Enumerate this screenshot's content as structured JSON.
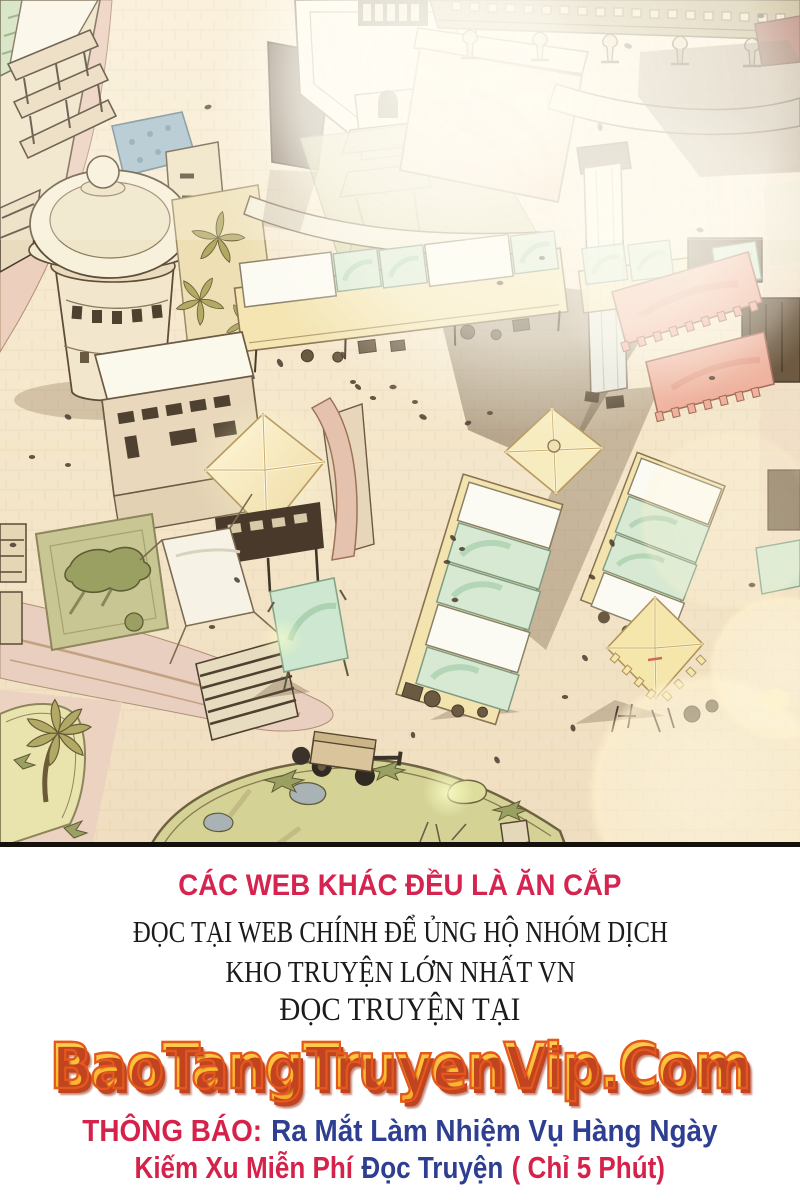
{
  "panel": {
    "caption": "Aerial view of a sunlit market plaza: domed tower, scaffolded buildings, rows of stalls with white and mint canopies, pink fringed awnings, glowing pavilion roofs, garden square, palm trees, a cart and a park, washed by bright lens flares",
    "palette": {
      "ground": "#f5e7cb",
      "road_pink": "#ecd2c0",
      "canopy_white": "#fcfbf3",
      "canopy_mint": "#d7e9d3",
      "awning_pink": "#efb29e",
      "roof_glow": "#f7ecc0",
      "garden_green": "#c8c794",
      "park_green": "#d4d295",
      "tower_cream": "#f2e7cc",
      "blue_roof": "#a9c2cd",
      "outline_brown": "#5e4d3a",
      "shadow_brown": "rgba(98,77,54,0.42)"
    }
  },
  "notice": {
    "warning": "CÁC WEB KHÁC ĐỀU LÀ ĂN CẮP",
    "support_line": "ĐỌC TẠI WEB CHÍNH ĐỂ ỦNG HỘ NHÓM DỊCH",
    "repo_line": "KHO TRUYỆN LỚN NHẤT VN",
    "read_at_line": "ĐỌC TRUYỆN TẠI",
    "site_name": "BaoTangTruyenVip.Com",
    "announcement_label": "THÔNG BÁO:",
    "announcement_text": "Ra Mắt Làm Nhiệm Vụ Hàng Ngày",
    "promo_part1": "Kiếm Xu Miễn Phí",
    "promo_part2": "Đọc Truyện",
    "promo_part3": "( Chỉ 5 Phút)",
    "colors": {
      "warning_red": "#d4244f",
      "body_black": "#1b1b1d",
      "logo_yellow": "#ffc53e",
      "logo_outline": "#e2581e",
      "logo_shadow": "#c2431f",
      "announce_red": "#d5224b",
      "announce_blue": "#2e3e91"
    }
  }
}
